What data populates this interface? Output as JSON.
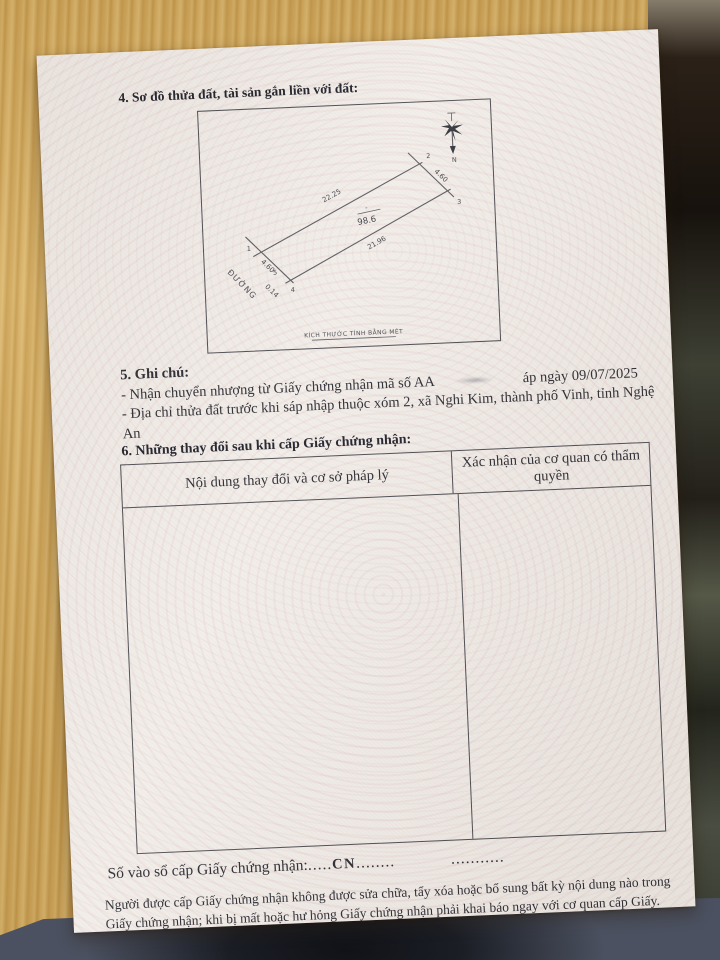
{
  "doc": {
    "section4_heading": "4. Sơ đồ thửa đất, tài sản gắn liền với đất:",
    "diagram": {
      "caption": "KÍCH THƯỚC TÍNH BẰNG MÉT",
      "road_label": "ĐƯỜNG",
      "north_label": "N",
      "parcel": {
        "area_label": "98.6",
        "area_top_mark": "-",
        "dim_top": "22.25",
        "dim_bottom": "21.96",
        "dim_right": "4.60",
        "dim_left": "4.60",
        "dim_offset": "0.14",
        "v1": "1",
        "v2": "2",
        "v3": "3",
        "v4": "4",
        "v5": "5"
      }
    },
    "section5": {
      "heading": "5. Ghi chú:",
      "note1_prefix": "- Nhận chuyển nhượng từ Giấy chứng nhận mã số AA",
      "note1_suffix": "áp ngày 09/07/2025",
      "note2": "- Địa chỉ thửa đất trước khi sáp nhập thuộc xóm 2, xã Nghi Kim, thành phố Vinh, tỉnh Nghệ An"
    },
    "section6": {
      "heading": "6. Những thay đổi sau khi cấp Giấy chứng nhận:",
      "table_col1": "Nội dung thay đổi và cơ sở pháp lý",
      "table_col2": "Xác nhận của cơ quan có thẩm quyền"
    },
    "bottom": {
      "registry_label": "Số vào sổ cấp Giấy chứng nhận:",
      "dots_left": ".....",
      "registry_code": "CN",
      "dots_mid": "........",
      "dots_right": "...........",
      "notice": "Người được cấp Giấy chứng nhận không được sửa chữa, tẩy xóa hoặc bổ sung bất kỳ nội dung nào trong Giấy chứng nhận; khi bị mất hoặc hư hỏng Giấy chứng nhận phải khai báo ngay với cơ quan cấp Giấy."
    },
    "colors": {
      "paper": "#f1ede8",
      "wood": "#cfa75e",
      "ink": "#2b2b33",
      "fabric": "#4b5160"
    }
  }
}
